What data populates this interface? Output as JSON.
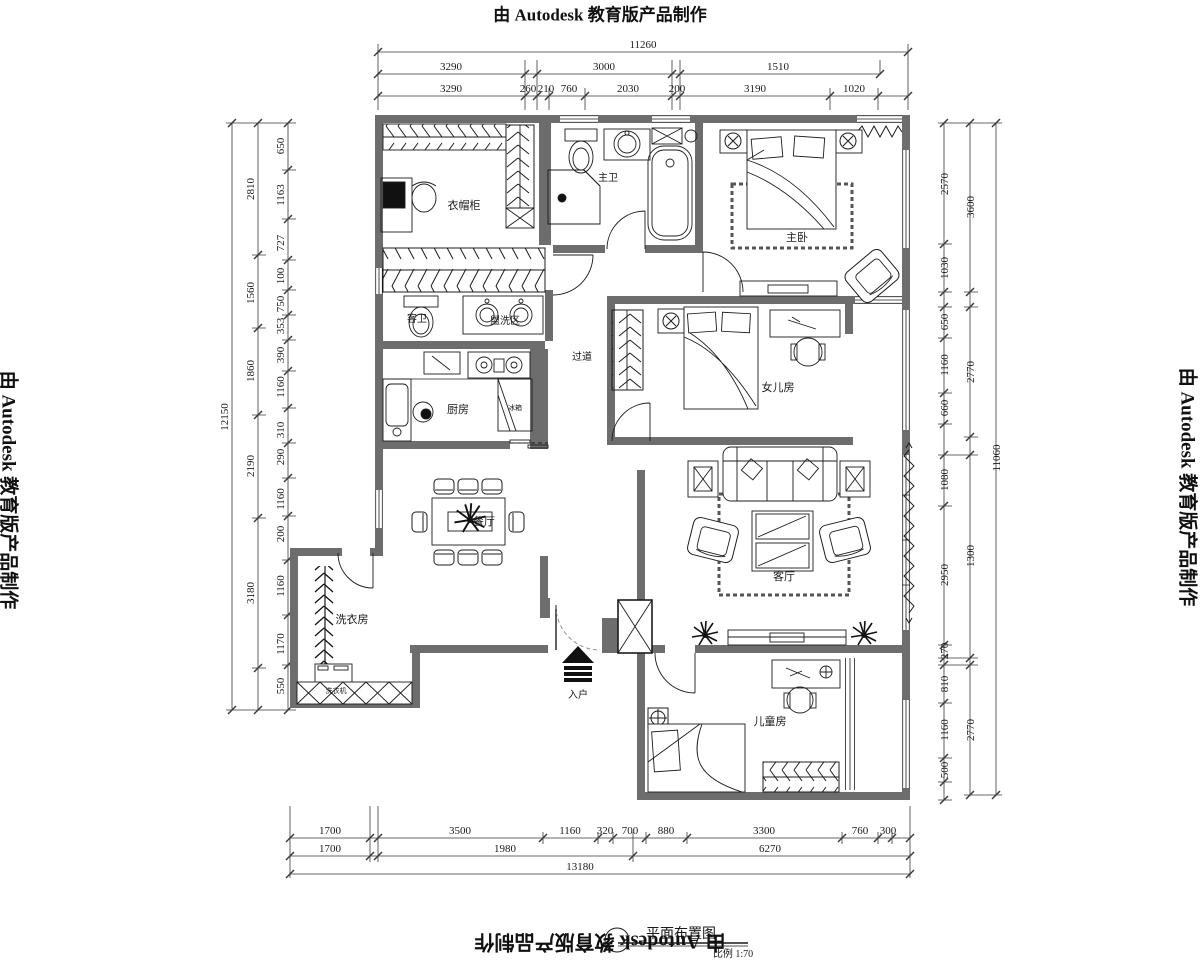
{
  "watermark": {
    "text": "由 Autodesk 教育版产品制作"
  },
  "title_block": {
    "title": "平面布置图",
    "scale": "比例 1:70"
  },
  "rooms": {
    "cloakroom": "衣帽柜",
    "master_bath": "主卫",
    "master_bedroom": "主卧",
    "guest_bath": "客卫",
    "wash_area": "盥洗区",
    "corridor": "过道",
    "kitchen": "厨房",
    "fridge": "冰箱",
    "dining": "餐厅",
    "daughter_room": "女儿房",
    "living_room": "客厅",
    "laundry": "洗衣房",
    "washer": "洗衣机",
    "entry": "入户",
    "kids_room": "儿童房"
  },
  "dims": {
    "top": {
      "row1": [
        "11260"
      ],
      "row2": [
        "3290",
        "3000",
        "1510"
      ],
      "row3": [
        "3290",
        "260",
        "210",
        "760",
        "2030",
        "200",
        "3190",
        "1020"
      ]
    },
    "left": {
      "outer": [
        "12150"
      ],
      "mid": [
        "2810",
        "1560",
        "1860",
        "2190",
        "3180"
      ],
      "inner": [
        "650",
        "1163",
        "727",
        "100",
        "750",
        "353",
        "390",
        "1160",
        "310",
        "290",
        "1160",
        "200",
        "1160",
        "1170",
        "550"
      ]
    },
    "right": {
      "outer": [
        "11060"
      ],
      "mid": [
        "3600",
        "2770",
        "1300",
        "2770"
      ],
      "inner": [
        "2570",
        "1030",
        "650",
        "1160",
        "660",
        "1080",
        "2950",
        "270",
        "810",
        "1160",
        "500"
      ]
    },
    "bottom": {
      "row1": [
        "1700",
        "3500",
        "1160",
        "320",
        "700",
        "880",
        "3300",
        "760",
        "300"
      ],
      "row2": [
        "1700",
        "1980",
        "6270"
      ],
      "row3": [
        "13180"
      ]
    }
  }
}
